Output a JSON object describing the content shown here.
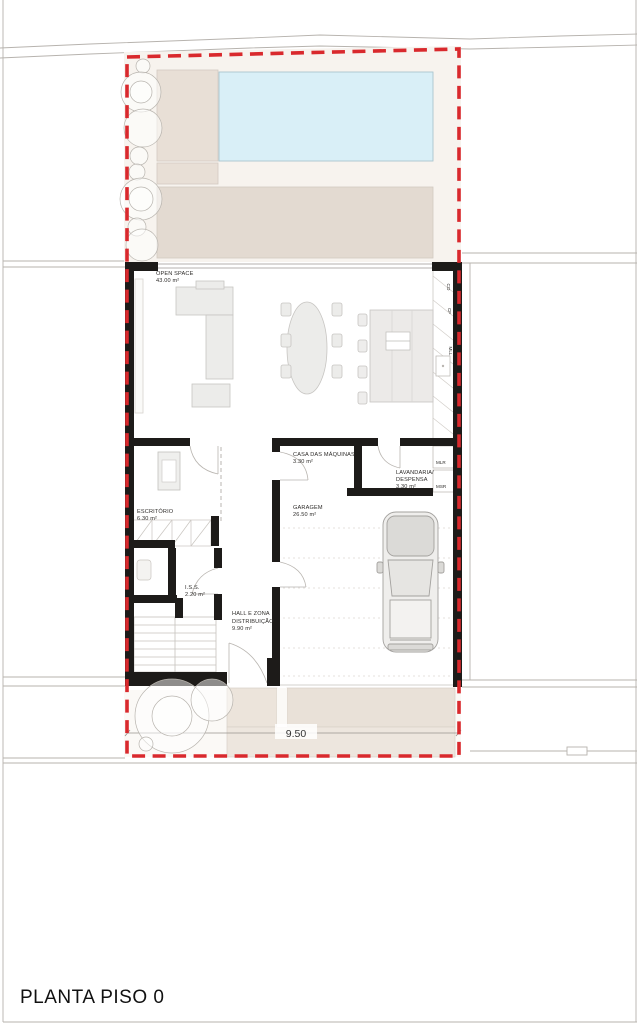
{
  "page": {
    "title": "PLANTA  PISO 0"
  },
  "site": {
    "dimension": "9.50"
  },
  "rooms": {
    "open_space": {
      "name": "OPEN SPACE",
      "area": "43.00 m²"
    },
    "escritorio": {
      "name": "ESCRITÓRIO",
      "area": "6.30 m²"
    },
    "iss": {
      "name": "I.S.S.",
      "area": "2.20 m²"
    },
    "hall": {
      "line1": "HALL E ZONA",
      "line2": "DISTRIBUIÇÃO",
      "area": "9.90 m²"
    },
    "casa_maquinas": {
      "name": "CASA DAS MÁQUINAS",
      "area": "3.30 m²"
    },
    "lavandaria": {
      "line1": "LAVANDARIA/",
      "line2": "DESPENSA",
      "area": "3.30 m²"
    },
    "garagem": {
      "name": "GARAGEM",
      "area": "26.50 m²"
    }
  },
  "labels": {
    "mlr": "MLR",
    "msr": "MSR",
    "co": "CO",
    "cf": "CF",
    "mll": "MLL"
  },
  "colors": {
    "boundary": "#d9292d",
    "wall": "#1d1b19",
    "pool": "#d9eff7",
    "deck": "#e8dfd6",
    "terrace": "#e3dad1",
    "driveway": "#e9e1d8",
    "driveway_light": "#ede6de",
    "garden": "#f7f3ee"
  }
}
